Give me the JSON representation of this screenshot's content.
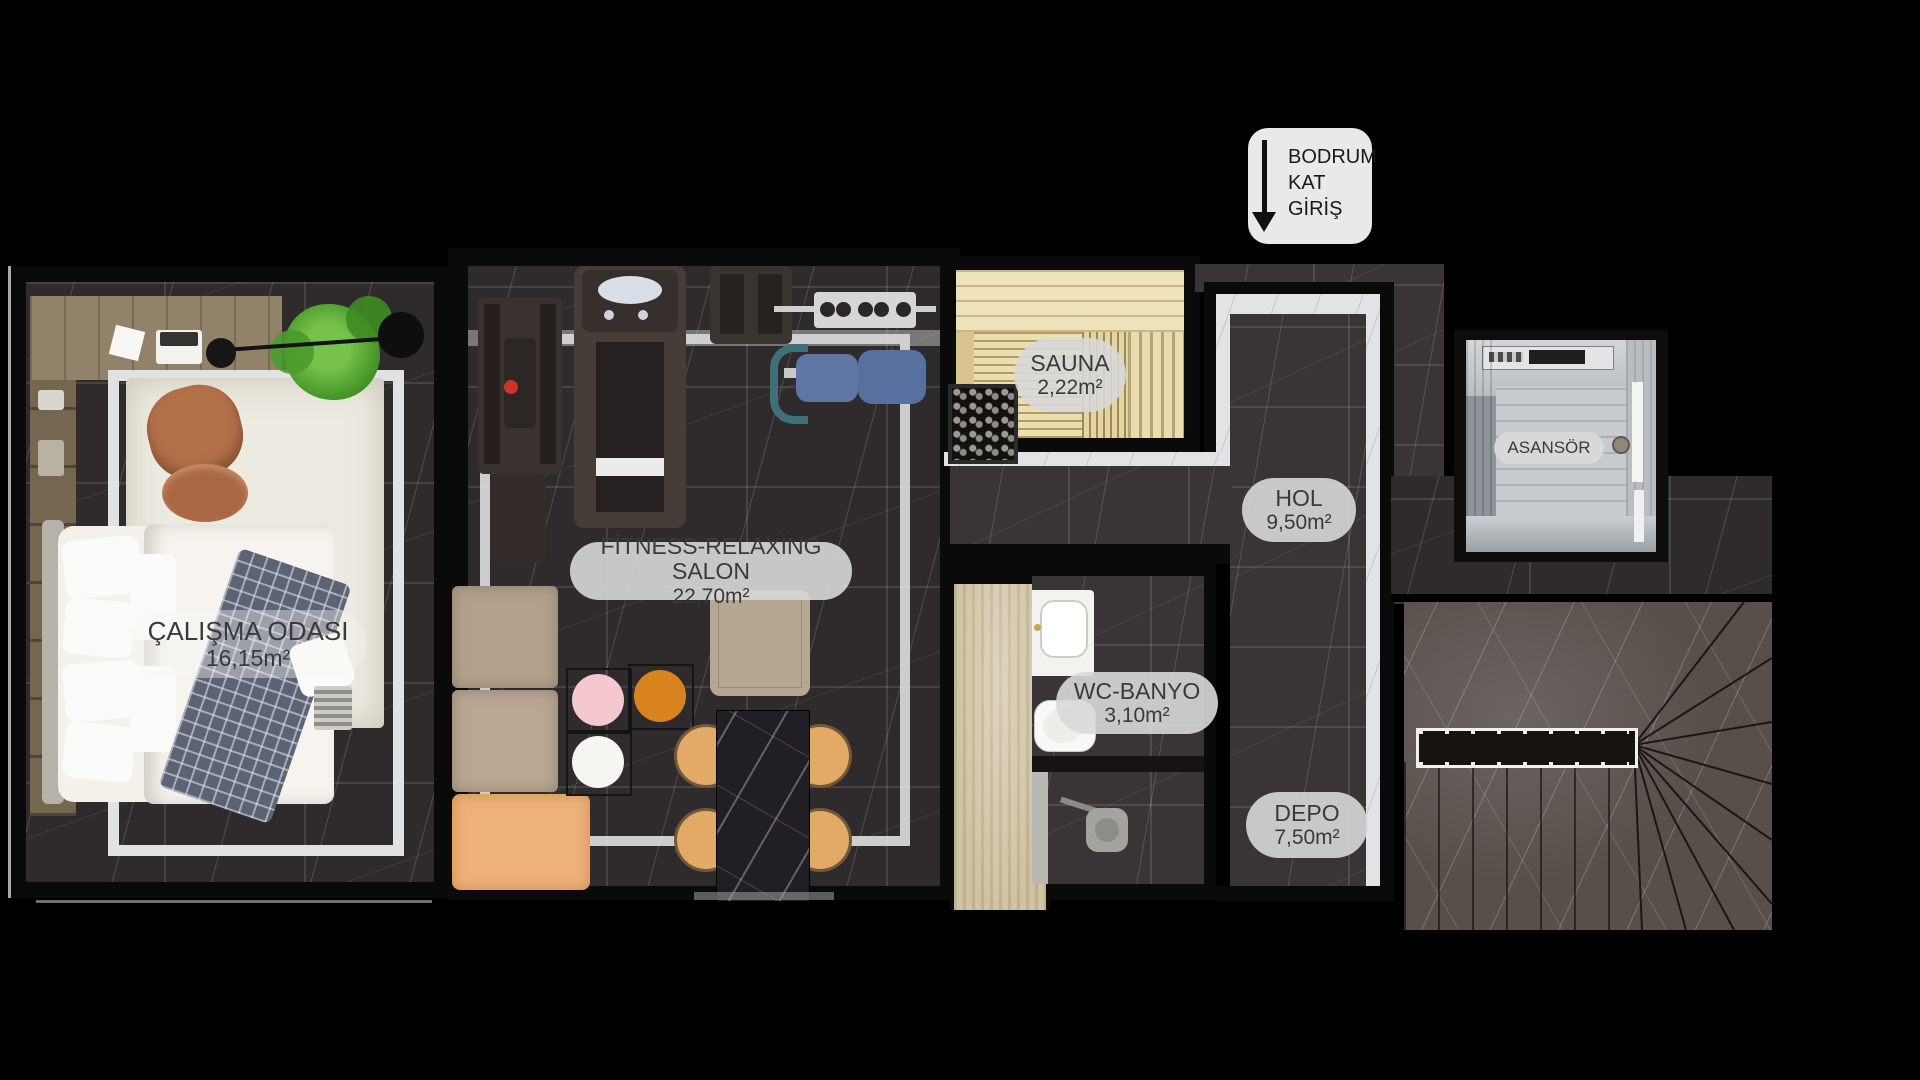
{
  "floor_plan": {
    "entrance_badge": {
      "lines": [
        "BODRUM",
        "KAT",
        "GİRİŞ"
      ]
    },
    "rooms": {
      "calisma_odasi": {
        "name": "ÇALIŞMA ODASI",
        "area": "16,15m²"
      },
      "fitness_salon": {
        "name": "FİTNESS-RELAXİNG SALON",
        "area": "22,70m²"
      },
      "sauna": {
        "name": "SAUNA",
        "area": "2,22m²"
      },
      "hol": {
        "name": "HOL",
        "area": "9,50m²"
      },
      "wc_banyo": {
        "name": "WC-BANYO",
        "area": "3,10m²"
      },
      "depo": {
        "name": "DEPO",
        "area": "7,50m²"
      },
      "asansor": {
        "name": "ASANSÖR"
      }
    },
    "colors": {
      "background": "#000000",
      "dark_marble_floor": "#2f2a2c",
      "hall_marble_floor": "#3b3437",
      "stair_marble": "#584f4b",
      "marble_band": "#e3e3e6",
      "sauna_wood": "#ecdfae",
      "travertine": "#d0c3a4",
      "label_pill": "#d9d9d9",
      "label_text": "#3a3a3a",
      "sofa_beige": "#b3a18d",
      "chaise_orange": "#edb278",
      "accent_pink": "#f5c7ce",
      "accent_orange": "#d9831f",
      "bench_blue": "#5f76a6",
      "leather_chair": "#b3714a",
      "plant_green": "#53a02e"
    }
  }
}
